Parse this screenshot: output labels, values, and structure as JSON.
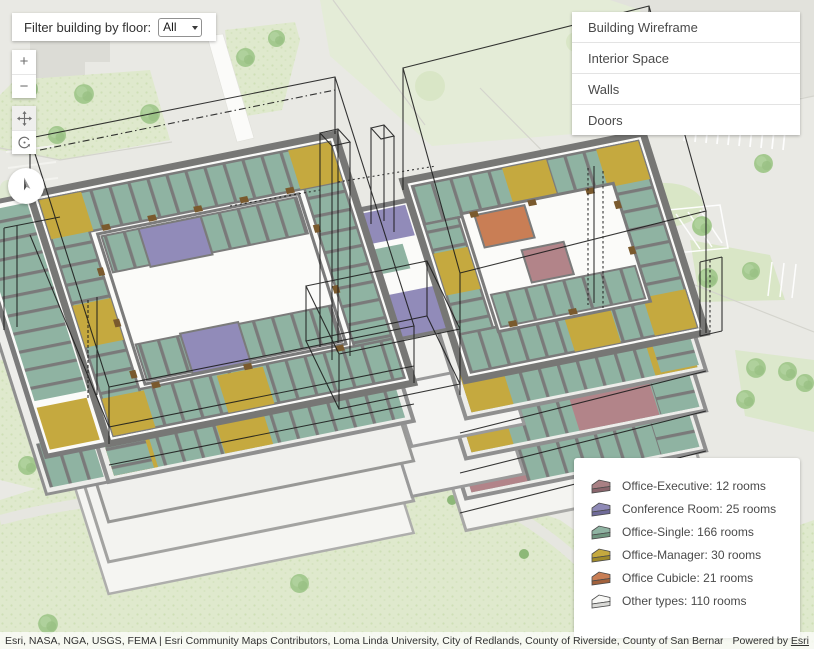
{
  "filter": {
    "label": "Filter building by floor:",
    "value": "All"
  },
  "icons": {
    "zoom_in": "+",
    "zoom_out": "−"
  },
  "layers": {
    "items": [
      {
        "label": "Building Wireframe"
      },
      {
        "label": "Interior Space"
      },
      {
        "label": "Walls"
      },
      {
        "label": "Doors"
      }
    ]
  },
  "legend": {
    "items": [
      {
        "label": "Office-Executive: 12 rooms",
        "color": "#a98084",
        "shade": "#8a656c"
      },
      {
        "label": "Conference Room: 25 rooms",
        "color": "#8f8ab7",
        "shade": "#6f6b99"
      },
      {
        "label": "Office-Single: 166 rooms",
        "color": "#8fb3a2",
        "shade": "#6f957f"
      },
      {
        "label": "Office-Manager: 30 rooms",
        "color": "#c5a93f",
        "shade": "#a08a2a"
      },
      {
        "label": "Office Cubicle: 21 rooms",
        "color": "#c87e55",
        "shade": "#a2613c"
      },
      {
        "label": "Other types: 110 rooms",
        "color": "#f8f8f6",
        "shade": "#d9d9d6"
      }
    ]
  },
  "attribution": {
    "sources": "Esri, NASA, NGA, USGS, FEMA | Esri Community Maps Contributors, Loma Linda University, City of Redlands, County of Riverside, County of San Bernardino, California State Pa...",
    "powered_by": "Powered by ",
    "powered_by_link": "Esri"
  },
  "colors": {
    "room_teal": "#8fb3a2",
    "room_yellow": "#c5a93f",
    "room_purple": "#918bb9",
    "room_orange": "#c97e55",
    "room_mauve": "#b28489",
    "walls": "#7b7b7b",
    "floor": "#fbfbf9",
    "wireframe": "#1b1b1b"
  }
}
